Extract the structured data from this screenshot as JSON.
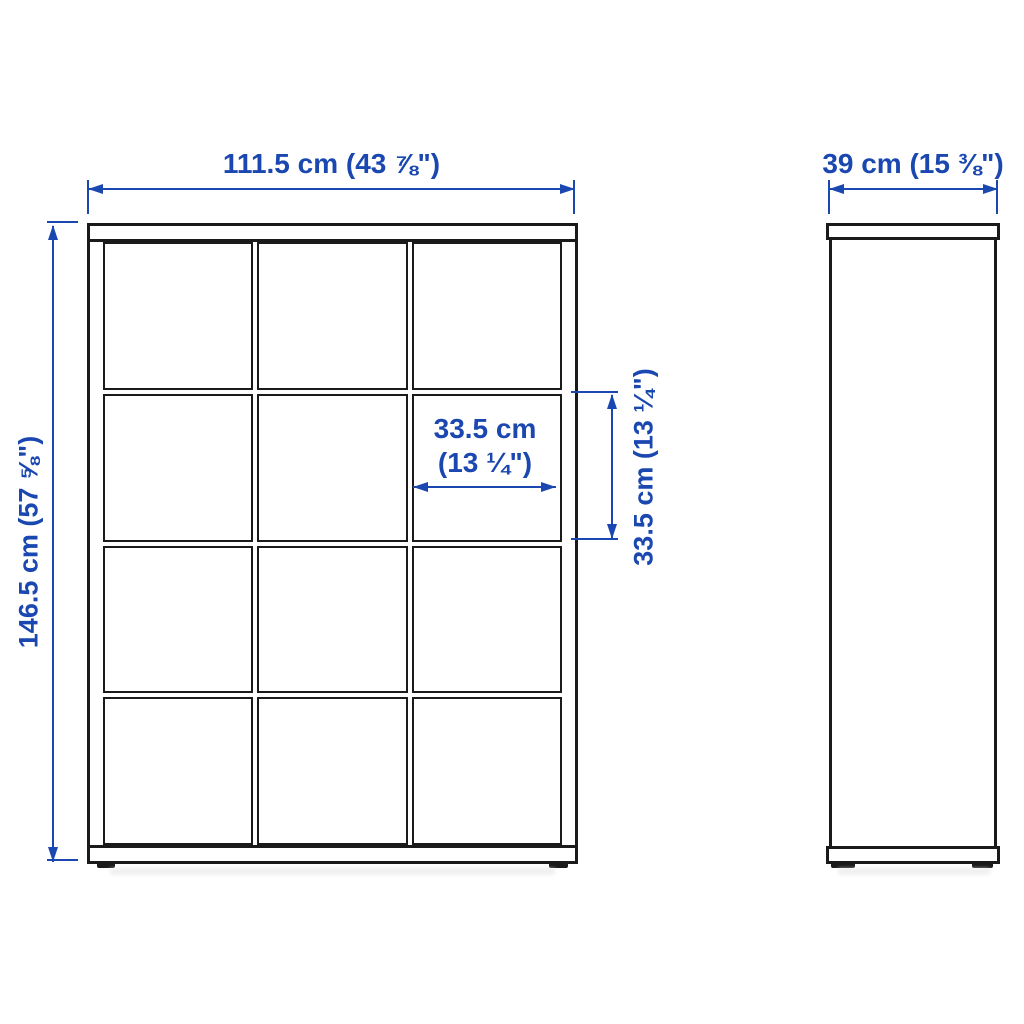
{
  "front_view": {
    "rows": 4,
    "columns": 3,
    "width_label": "111.5 cm (43 ⅞\")",
    "height_label": "146.5 cm (57 ⅝\")",
    "cube_width_label_line1": "33.5 cm",
    "cube_width_label_line2": "(13 ¼\")",
    "cube_height_label": "33.5 cm (13 ¼\")"
  },
  "side_view": {
    "depth_label": "39 cm (15 ⅜\")"
  },
  "colors": {
    "dimension_blue": "#1a47b0",
    "outline_black": "#1a1a1a",
    "background": "#ffffff"
  }
}
